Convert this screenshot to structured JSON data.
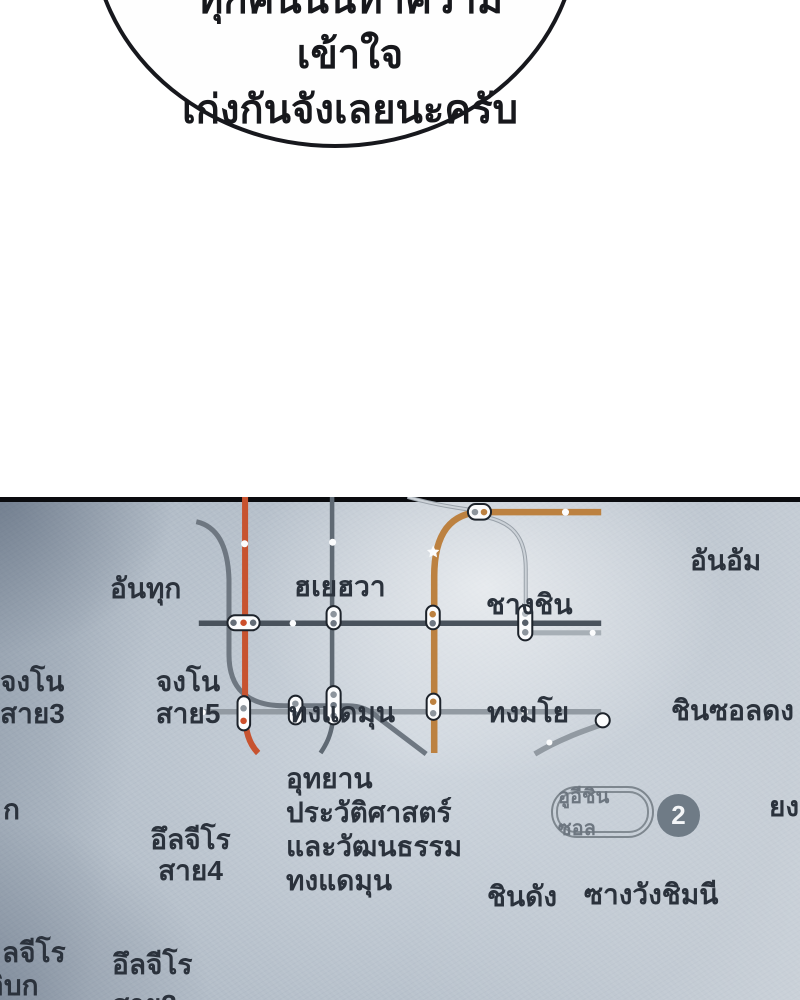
{
  "bubble": {
    "line1": "ทุกคนนั้นทำความเข้าใจ",
    "line2": "เก่งกันจังเลยนะครับ"
  },
  "map": {
    "stations": {
      "antuk": "อันทุก",
      "hyehwa": "ฮเยฮวา",
      "changsin": "ชางชิน",
      "anam": "อันอัม",
      "jongno3_l1": "จงโน",
      "jongno3_l2": "สาย3",
      "jongno5_l1": "จงโน",
      "jongno5_l2": "สาย5",
      "dongdaemun": "ทงแดมุน",
      "dongmyo": "ทงมโย",
      "sinseoldong": "ชินซอลดง",
      "ddp_l1": "อุทยาน",
      "ddp_l2": "ประวัติศาสตร์",
      "ddp_l3": "และวัฒนธรรม",
      "ddp_l4": "ทงแดมุน",
      "euljiro4_l1": "อึลจีโร",
      "euljiro4_l2": "สาย4",
      "euljiro3_l1": "อึลจีโร",
      "euljiro3_l2": "สาย3",
      "sindang": "ชินดัง",
      "sangwangsimni": "ซางวังชิมนี",
      "partial_left_l1": "ลจีโร",
      "partial_left_l2": "อิบก",
      "partial_right": "ยง",
      "partial_ka": "ก"
    },
    "badges": {
      "uisinseol": "อูอีชินซอล",
      "line2_number": "2"
    },
    "colors": {
      "line1": "#49525c",
      "line2": "#929aa2",
      "line2_branch": "#a7afb6",
      "line3": "#c7532f",
      "line4": "#5f6973",
      "line5": "#6e7781",
      "line6": "#bc8140",
      "lrt": "#99a1a9",
      "lrt_core": "#ccd2d8",
      "capsule_outline": "#1d232b",
      "white": "#fbfcfd",
      "dot_gray": "#8d959d",
      "dot_dark": "#6f7883",
      "dot_mid": "#646d77",
      "dot_darkest": "#565f69",
      "dot_light": "#b6bdc3",
      "dot_orange": "#cc4f2b",
      "dot_tan": "#bc8140",
      "text": "#2b323c"
    }
  }
}
